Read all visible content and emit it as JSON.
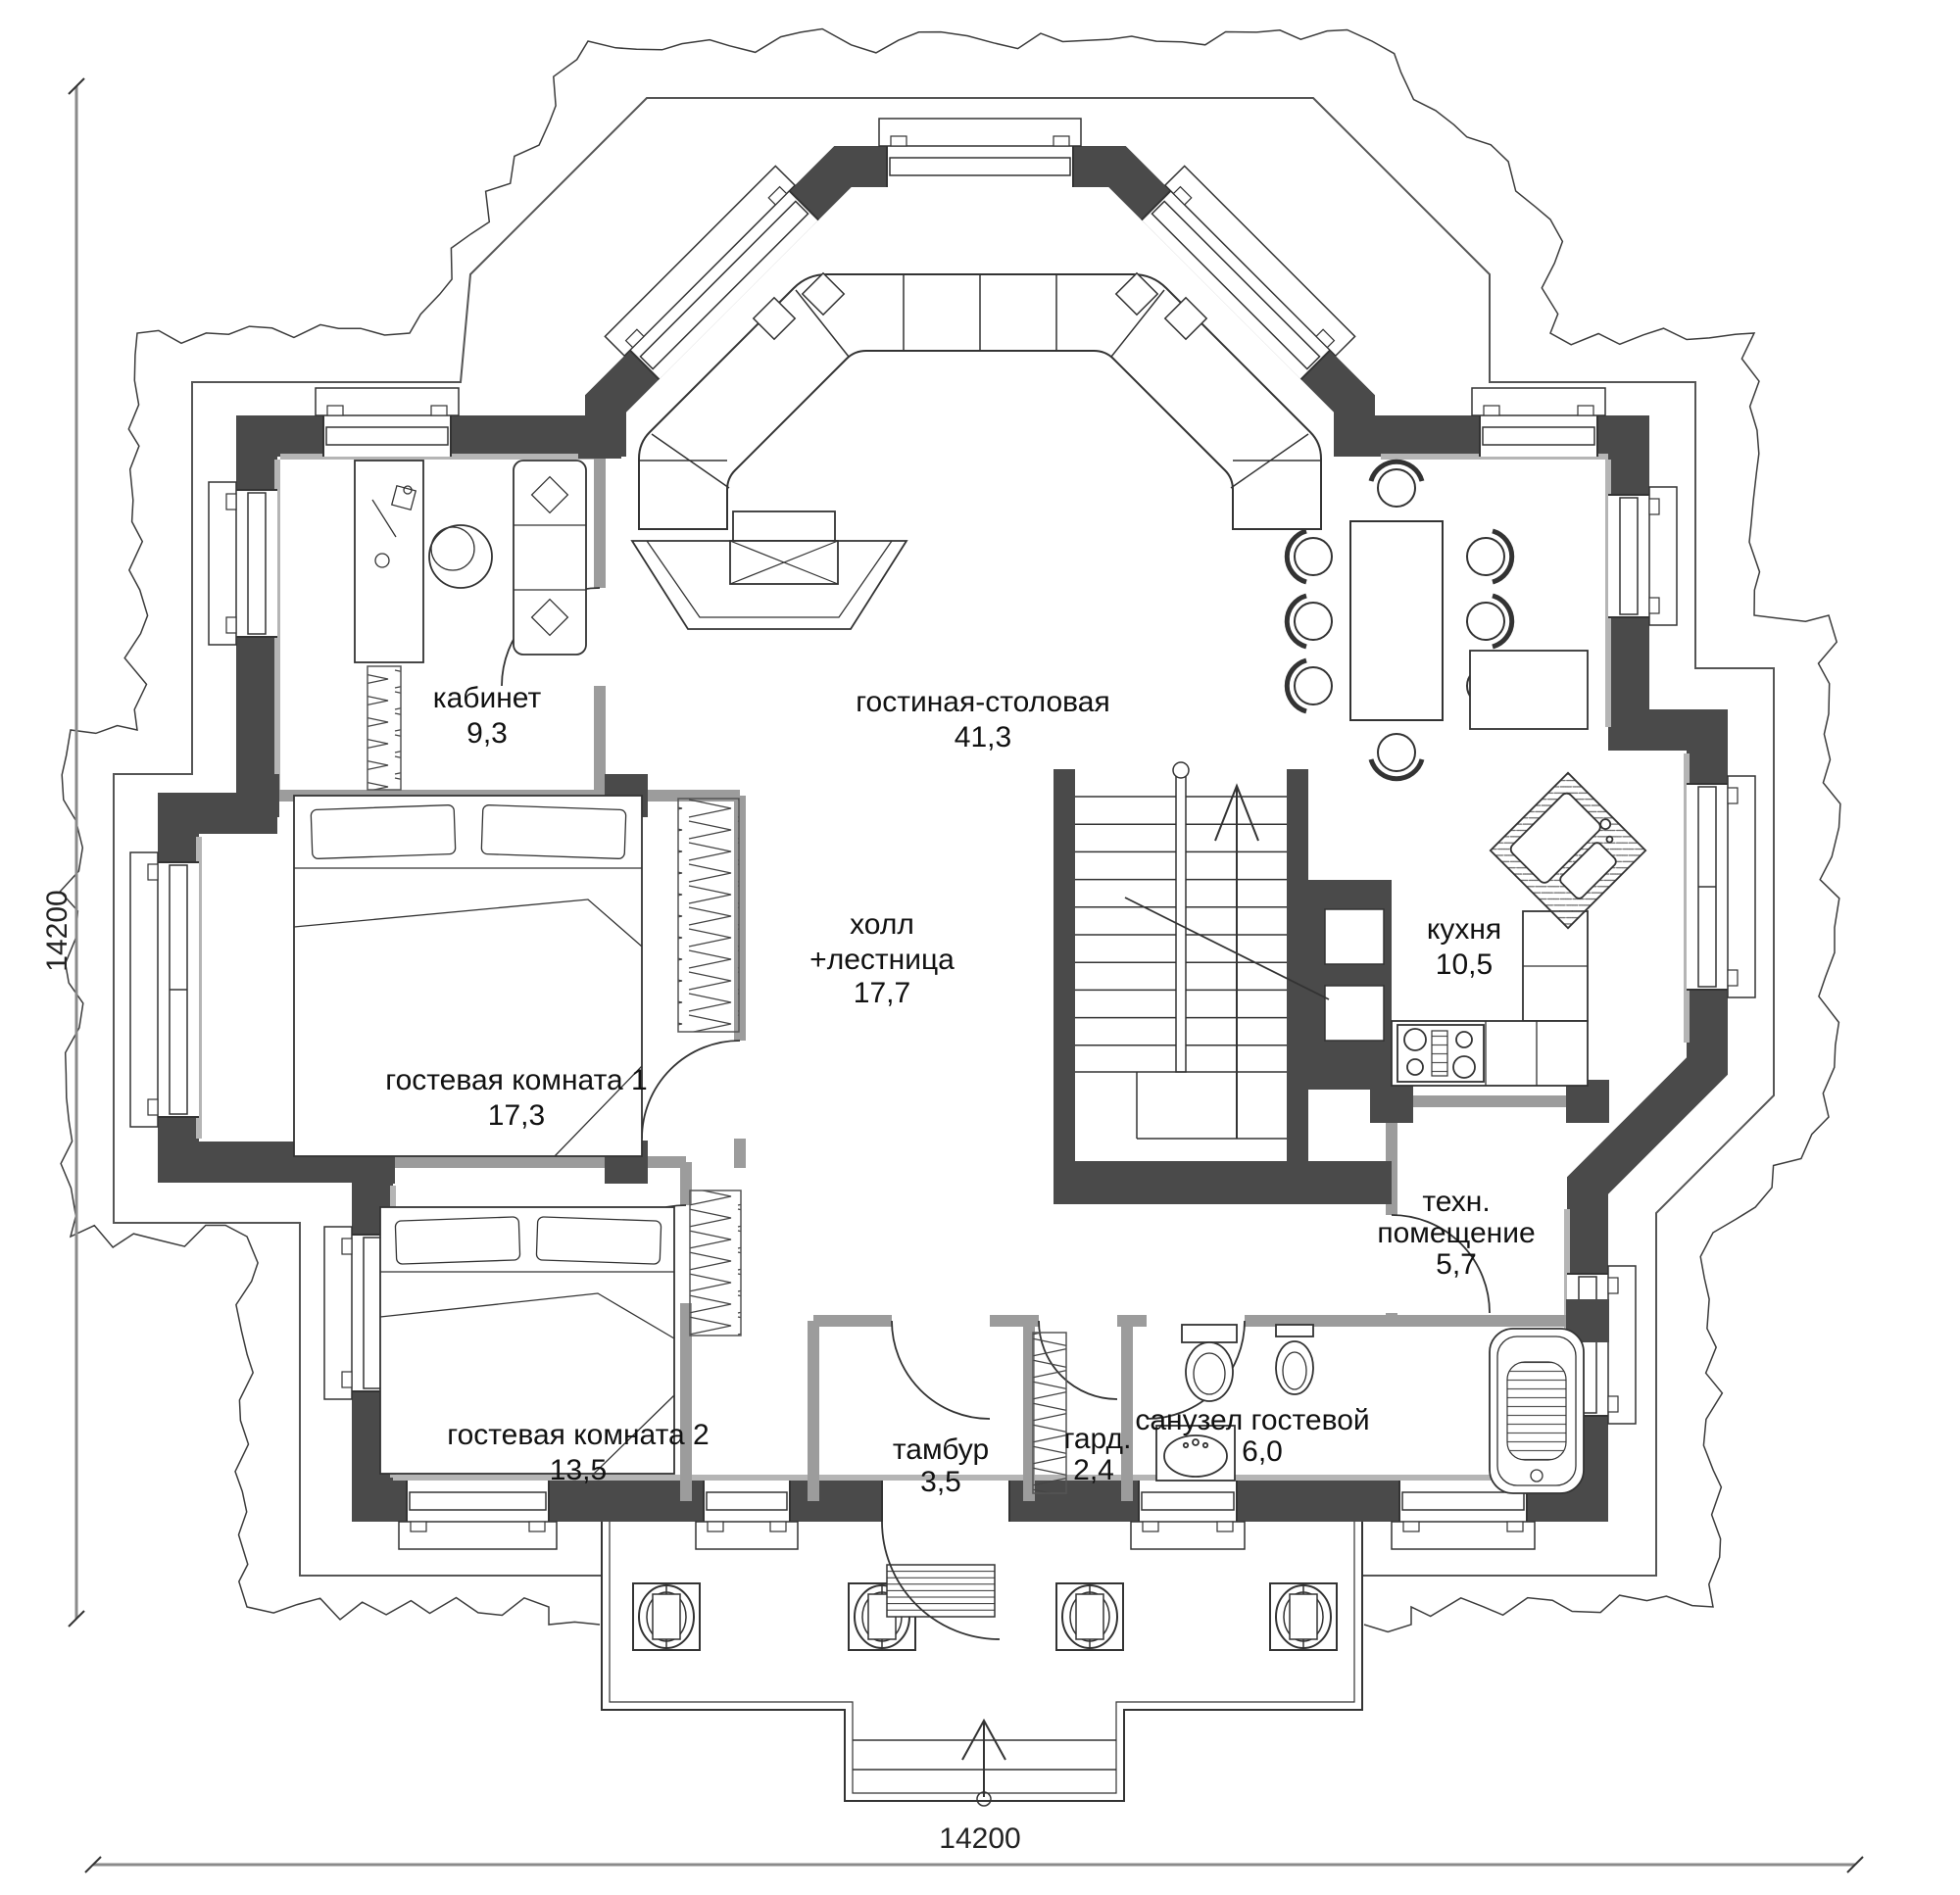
{
  "drawing": {
    "type": "floor-plan",
    "language": "ru",
    "rooms": {
      "office": {
        "label": "кабинет",
        "area": "9,3"
      },
      "living": {
        "label": "гостиная-столовая",
        "area": "41,3"
      },
      "hall": {
        "line1": "холл",
        "line2": "+лестница",
        "area": "17,7"
      },
      "kitchen": {
        "label": "кухня",
        "area": "10,5"
      },
      "guest1": {
        "label": "гостевая комната 1",
        "area": "17,3"
      },
      "guest2": {
        "label": "гостевая комната 2",
        "area": "13,5"
      },
      "tambour": {
        "label": "тамбур",
        "area": "3,5"
      },
      "wardrobe": {
        "label": "гард.",
        "area": "2,4"
      },
      "bathroom": {
        "label": "санузел гостевой",
        "area": "6,0"
      },
      "tech": {
        "line1": "техн.",
        "line2": "помещение",
        "area": "5,7"
      }
    },
    "dimensions": {
      "width": "14200",
      "depth": "14200"
    },
    "colors": {
      "wall": "#4a4a4a",
      "partition": "#9c9c9c",
      "line": "#333333",
      "background": "#ffffff"
    }
  }
}
